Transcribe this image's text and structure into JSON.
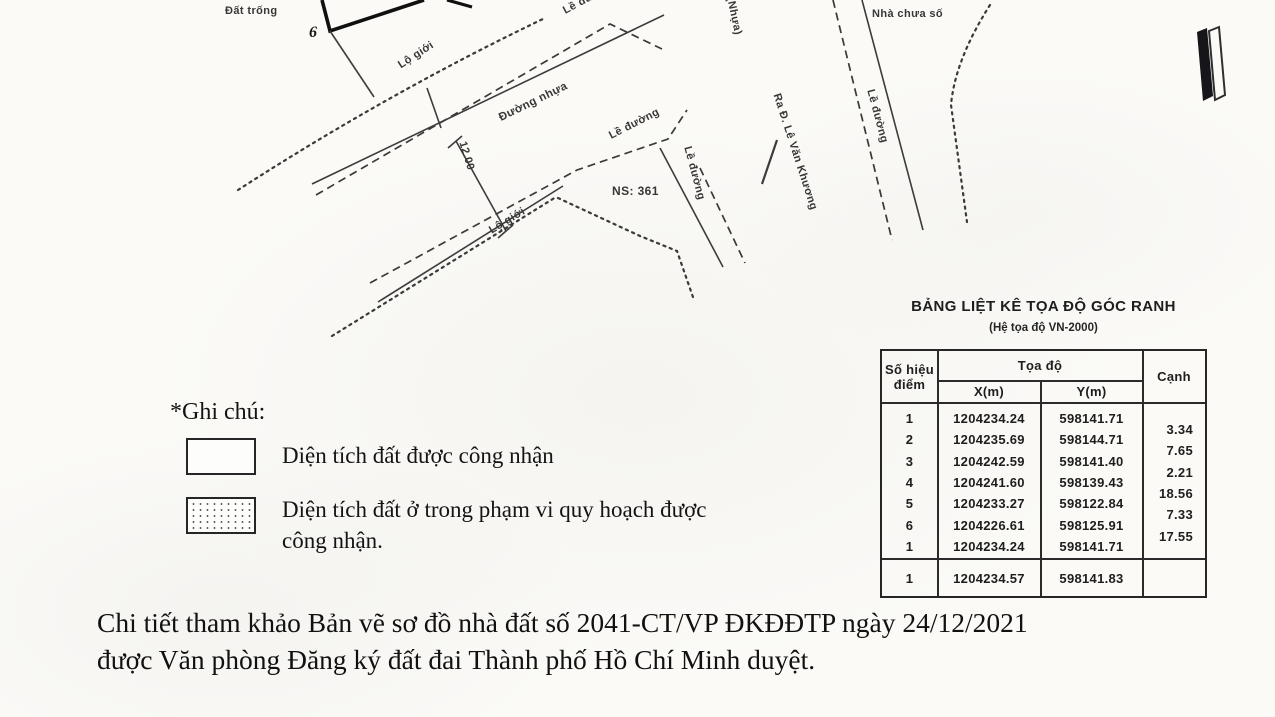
{
  "page": {
    "paper_color": "#fbfaf7",
    "ink_color": "#1c1c1c",
    "footer_line1": "Chi tiết tham khảo Bản vẽ sơ đồ nhà đất số 2041-CT/VP ĐKĐĐTP ngày 24/12/2021",
    "footer_line2": "được Văn phòng Đăng ký đất đai Thành phố Hồ Chí Minh duyệt."
  },
  "map": {
    "labels": {
      "dat_trong": "Đất trống",
      "point_6": "6",
      "lo_gioi_1": "Lộ giới",
      "le_duong_1": "Lề đường",
      "duong_nhua": "Đường nhựa",
      "dimension_12": "12.00",
      "lo_gioi_2": "Lộ giới",
      "le_duong_2": "Lề đường",
      "le_duong_3": "Lề đường",
      "le_duong_4": "Lề đường",
      "ns_361": "NS: 361",
      "nhua": "(Nhựa)",
      "ra_duong": "Ra Đ. Lê Văn Khương",
      "nha_chua_so": "Nhà chưa số"
    }
  },
  "legend": {
    "heading": "*Ghi chú:",
    "items": [
      {
        "swatch": "plain",
        "label": "Diện tích đất được công nhận"
      },
      {
        "swatch": "dotted",
        "label": "Diện tích đất ở trong phạm vi quy hoạch được công nhận."
      }
    ]
  },
  "table": {
    "title": "BẢNG LIỆT KÊ TỌA ĐỘ GÓC RANH",
    "subtitle": "(Hệ tọa độ VN-2000)",
    "headers": {
      "point": "Số hiệu điểm",
      "coords": "Tọa độ",
      "x": "X(m)",
      "y": "Y(m)",
      "edge": "Cạnh"
    },
    "rows": [
      {
        "point": "1",
        "x": "1204234.24",
        "y": "598141.71"
      },
      {
        "point": "2",
        "x": "1204235.69",
        "y": "598144.71"
      },
      {
        "point": "3",
        "x": "1204242.59",
        "y": "598141.40"
      },
      {
        "point": "4",
        "x": "1204241.60",
        "y": "598139.43"
      },
      {
        "point": "5",
        "x": "1204233.27",
        "y": "598122.84"
      },
      {
        "point": "6",
        "x": "1204226.61",
        "y": "598125.91"
      },
      {
        "point": "1",
        "x": "1204234.24",
        "y": "598141.71"
      }
    ],
    "edges": [
      "3.34",
      "7.65",
      "2.21",
      "18.56",
      "7.33",
      "17.55"
    ],
    "summary": {
      "point": "1",
      "x": "1204234.57",
      "y": "598141.83"
    }
  }
}
